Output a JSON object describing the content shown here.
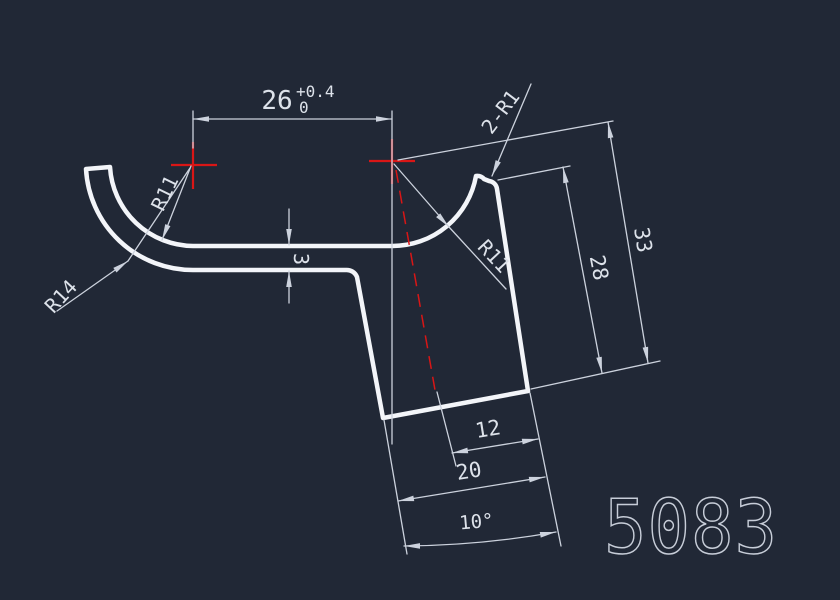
{
  "canvas": {
    "type": "cad-drawing-viewport",
    "part_number": "5083"
  },
  "colors": {
    "background": "#212836",
    "outline": "#f3f5f9",
    "dim": "#ccd2dd",
    "text": "#dde2ea",
    "red": "#d91616",
    "part_number": "#c7cdd8"
  },
  "dimensions": {
    "width_26": {
      "value": "26",
      "tol_plus": "+0.4",
      "tol_minus": "0"
    },
    "thickness_3": "3",
    "radius_r11_left": "R11",
    "radius_r14_left": "R14",
    "radius_r11_right": "R11",
    "tip_radii": "2-R1",
    "height_28": "28",
    "height_33": "33",
    "width_12": "12",
    "width_20": "20",
    "angle_10": "10°"
  }
}
